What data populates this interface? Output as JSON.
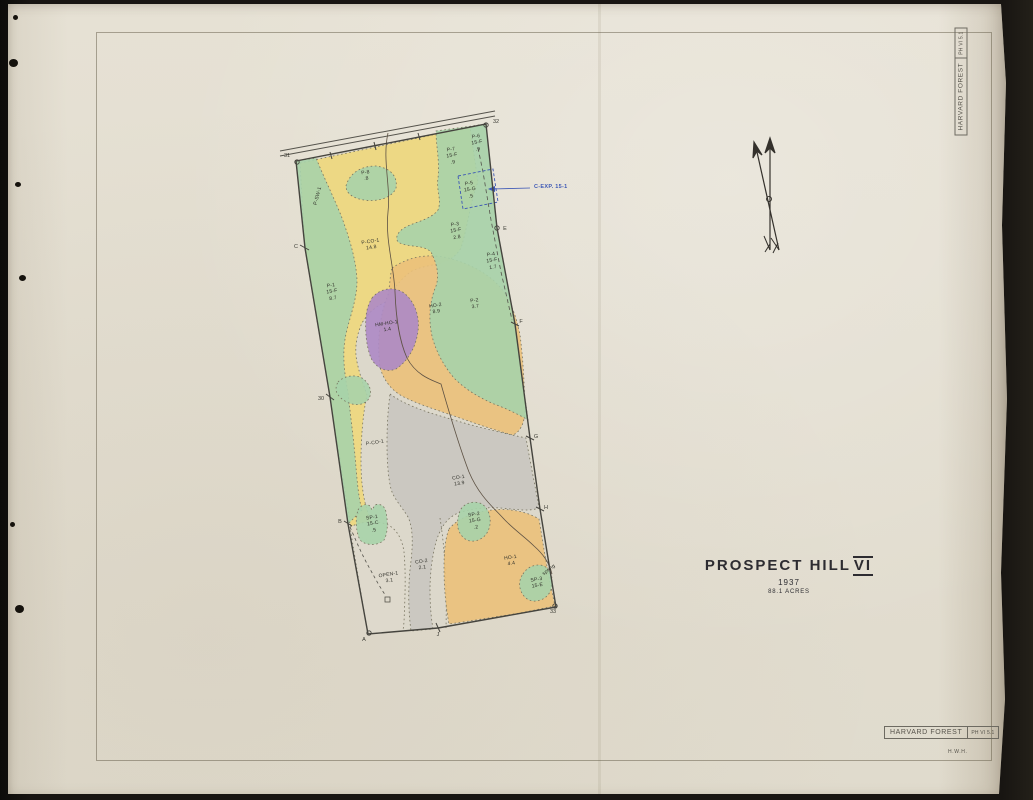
{
  "palette": {
    "paper": "#e4dfd2",
    "map_base": "#dcd8cb",
    "yellow": "#eed87c",
    "green": "#a7d3aa",
    "orange": "#ebc17a",
    "purple": "#ad8ac5",
    "gray": "#c9c7c0",
    "open_white": "#ded9cc",
    "blue_ink": "#3c57b5",
    "black_ink": "#35342f"
  },
  "title_block": {
    "name": "PROSPECT HILL",
    "numeral": "VI",
    "year": "1937",
    "acreage": "88.1 ACRES"
  },
  "stamps": {
    "top_right": {
      "org": "HARVARD FOREST",
      "code": "PH VI 5.1"
    },
    "bottom_right": {
      "org": "HARVARD FOREST",
      "code": "PH VI 5.1"
    },
    "initials": "H.W.H."
  },
  "annotations": {
    "experiment": "C-EXP. 15-1"
  },
  "stand_labels": [
    {
      "text": "P-8\n.8"
    },
    {
      "text": "P-7\n15-F\n.9"
    },
    {
      "text": "P-6\n15-F\n.9"
    },
    {
      "text": "P-5\n15-G\n.5"
    },
    {
      "text": "P-3\n15-F\n2.8"
    },
    {
      "text": "P-4\n15-F\n1.7"
    },
    {
      "text": "P-CO-1\n14.8"
    },
    {
      "text": "P-1\n15-F\n8.7"
    },
    {
      "text": "HM-HO-1\n1.4"
    },
    {
      "text": "HO-2\n8.9"
    },
    {
      "text": "P-2\n3.7"
    },
    {
      "text": "P-CO-1"
    },
    {
      "text": "CO-1\n13.9"
    },
    {
      "text": "SP-1\n15-C\n.5"
    },
    {
      "text": "SP-2\n15-G\n.2"
    },
    {
      "text": "OPEN-1\n3.1"
    },
    {
      "text": "CO-2\n2.1"
    },
    {
      "text": "HO-1\n4.4"
    },
    {
      "text": "SP-3\n15-E"
    },
    {
      "text": "P-SW-1"
    },
    {
      "text": "spring"
    }
  ],
  "edge_markers": [
    {
      "text": "31"
    },
    {
      "text": "32"
    },
    {
      "text": "C"
    },
    {
      "text": "30"
    },
    {
      "text": "B"
    },
    {
      "text": "A"
    },
    {
      "text": "J"
    },
    {
      "text": "33"
    },
    {
      "text": "E"
    },
    {
      "text": "F"
    },
    {
      "text": "G"
    },
    {
      "text": "H"
    }
  ]
}
